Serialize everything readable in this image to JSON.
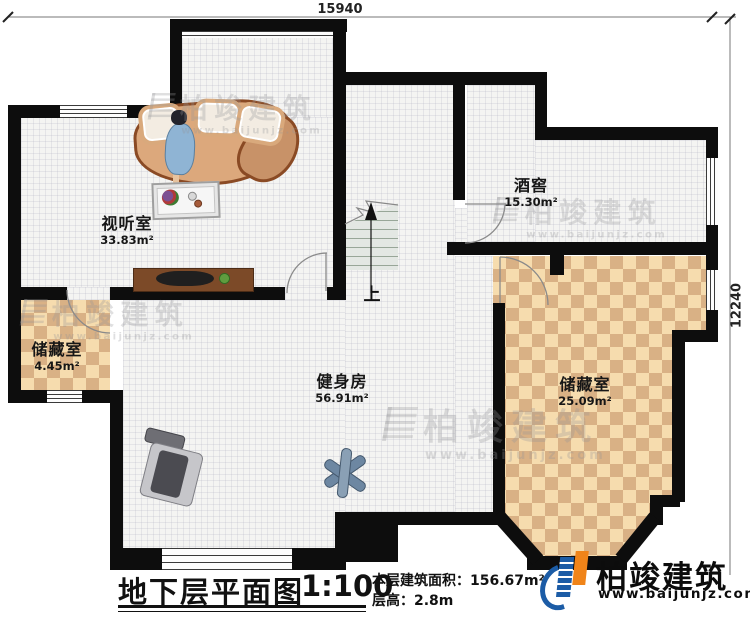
{
  "dimensions": {
    "top": "15940",
    "right": "12240"
  },
  "rooms": [
    {
      "name": "视听室",
      "area": "33.83m²"
    },
    {
      "name": "酒窖",
      "area": "15.30m²"
    },
    {
      "name": "储藏室",
      "area": "4.45m²"
    },
    {
      "name": "健身房",
      "area": "56.91m²"
    },
    {
      "name": "储藏室",
      "area": "25.09m²"
    }
  ],
  "stairs": {
    "up_label": "上"
  },
  "title_block": {
    "title": "地下层平面图",
    "scale": "1:100",
    "area_label": "本层建筑面积：",
    "area_value": "156.67m²",
    "height_label": "层高：",
    "height_value": "2.8m"
  },
  "logo": {
    "name": "柏竣建筑",
    "url": "www.baijunjz.com"
  },
  "watermark": {
    "name": "柏竣建筑",
    "url": "www.baijunjz.com"
  },
  "colors": {
    "wall": "#0d0d0d",
    "checker_light": "#f6dcae",
    "checker_dark": "#d9b185",
    "logo_blue": "#1c5ca6",
    "logo_orange": "#f08419"
  }
}
